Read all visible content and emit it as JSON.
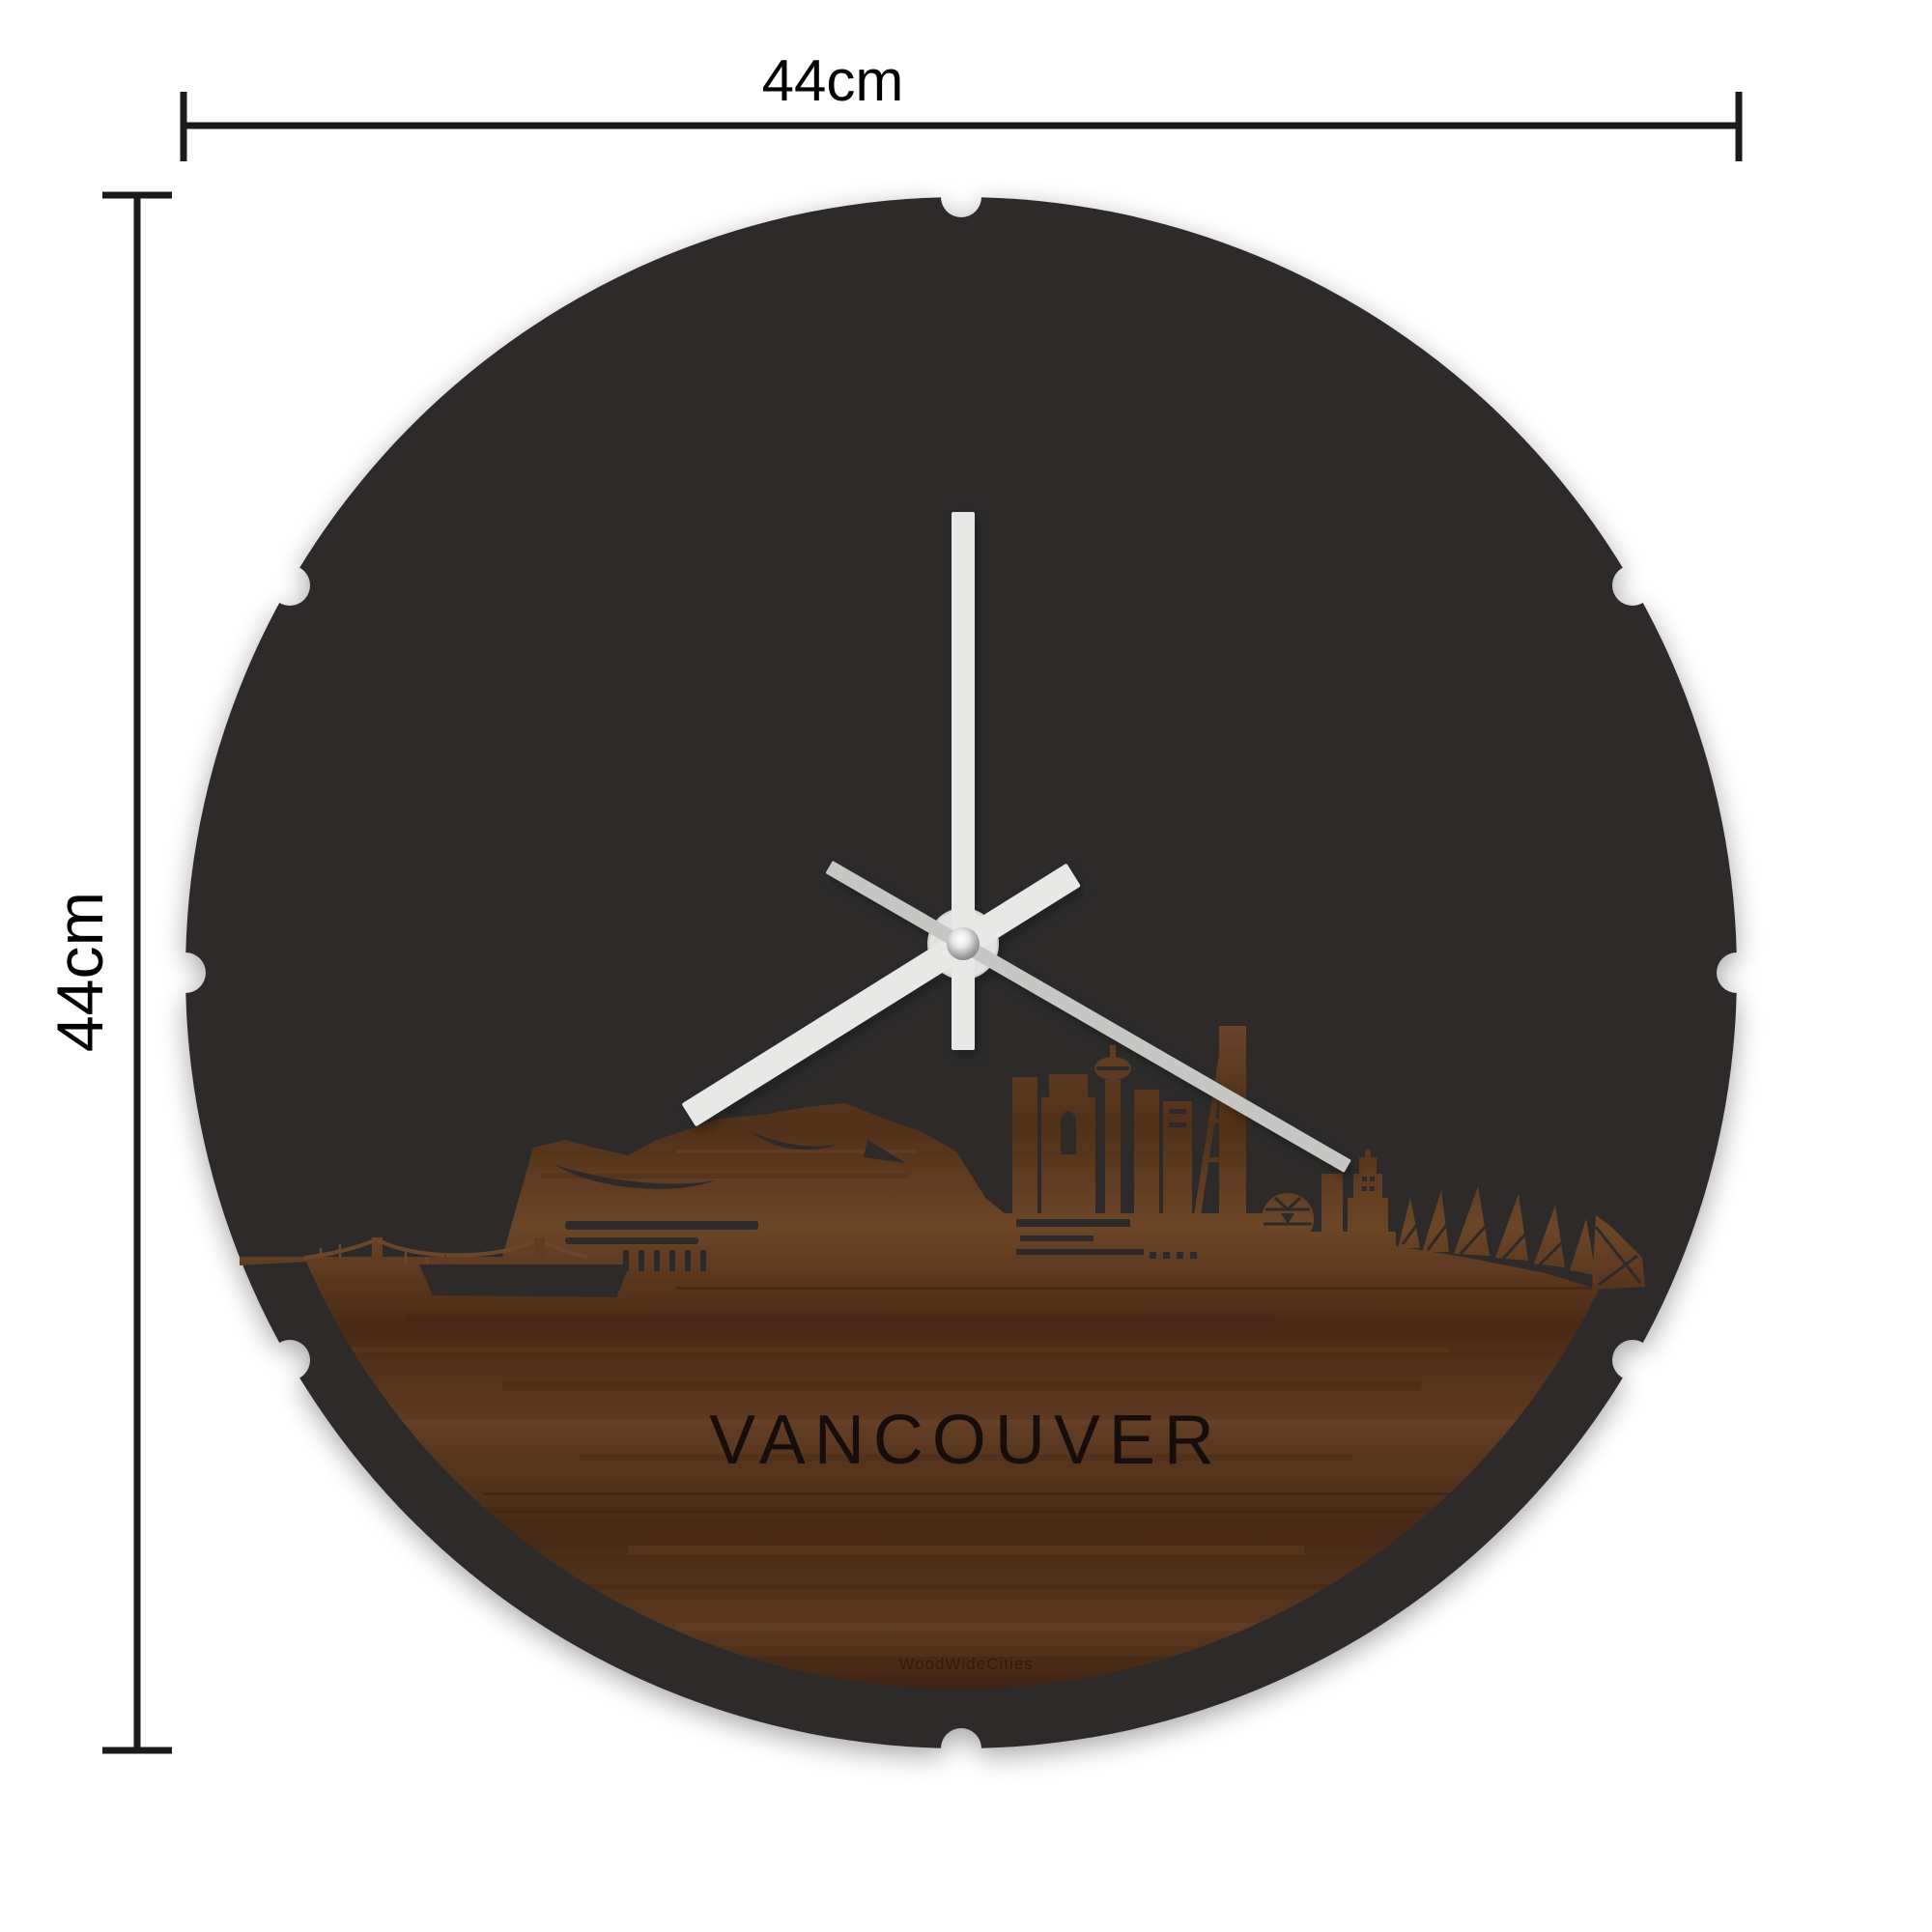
{
  "page": {
    "background": "#ffffff"
  },
  "dimensions": {
    "width_label": "44cm",
    "height_label": "44cm",
    "line_color": "#1b1b1b"
  },
  "clock": {
    "city_label": "VANCOUVER",
    "brand_label": "WoodWideCities",
    "face_color": "#2d2c2b",
    "hand_color": "#e8e8e6",
    "second_hand_color": "#c6c6c4",
    "label_color": "#17100b",
    "brand_color": "#2a1a0e",
    "hand_angles_deg": {
      "hour": 238,
      "minute": 0,
      "second": 120
    },
    "mounting_notches": {
      "count": 8,
      "angles_deg": [
        0,
        30,
        90,
        150,
        180,
        210,
        270,
        330
      ]
    },
    "skyline_city": "Vancouver",
    "wood_colors": {
      "dark": "#381f0f",
      "mid": "#5e3b22",
      "light": "#7c5130"
    }
  }
}
